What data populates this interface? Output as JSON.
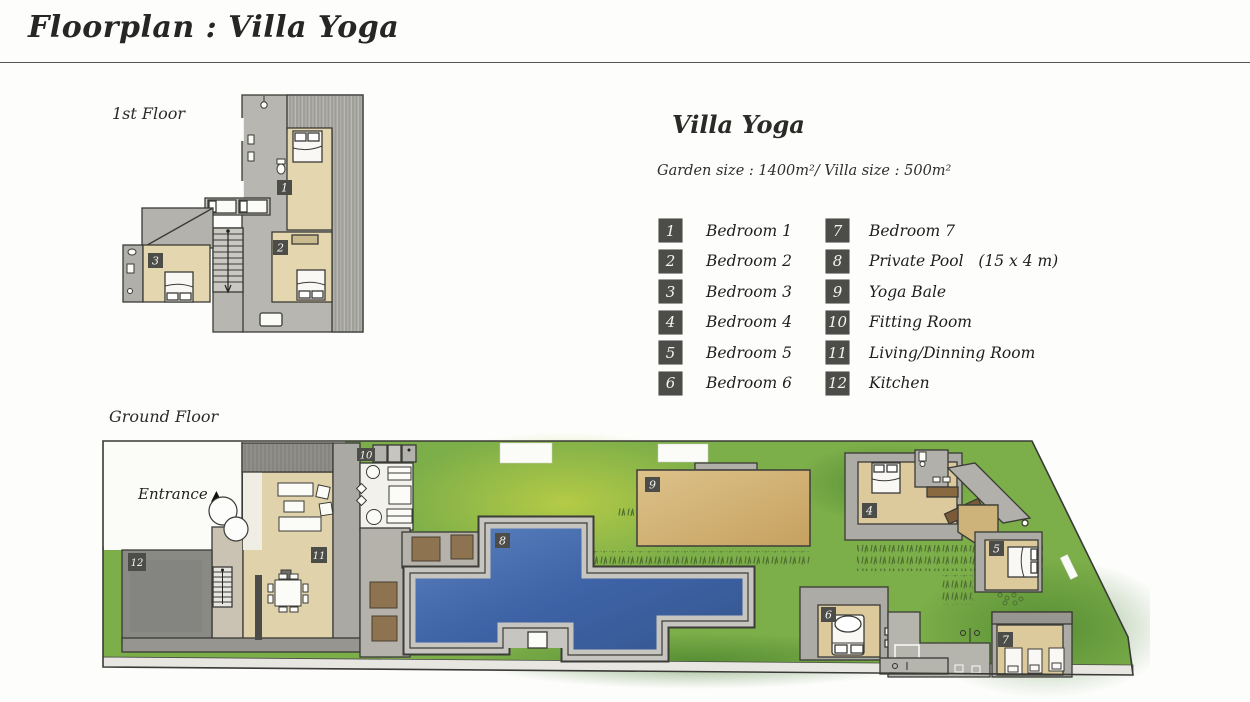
{
  "title": "Floorplan : Villa Yoga",
  "first_floor": {
    "label": "1st Floor"
  },
  "ground_floor": {
    "label": "Ground Floor",
    "entrance_label": "Entrance",
    "entrance_arrow": "▲"
  },
  "villa": {
    "name": "Villa Yoga",
    "size_line": "Garden size : 1400m²/ Villa size : 500m²"
  },
  "legend": {
    "items": [
      {
        "num": "1",
        "label": "Bedroom 1"
      },
      {
        "num": "2",
        "label": "Bedroom 2"
      },
      {
        "num": "3",
        "label": "Bedroom 3"
      },
      {
        "num": "4",
        "label": "Bedroom 4"
      },
      {
        "num": "5",
        "label": "Bedroom 5"
      },
      {
        "num": "6",
        "label": "Bedroom 6"
      },
      {
        "num": "7",
        "label": "Bedroom 7"
      },
      {
        "num": "8",
        "label": "Private Pool   (15 x 4 m)"
      },
      {
        "num": "9",
        "label": "Yoga Bale"
      },
      {
        "num": "10",
        "label": "Fitting Room"
      },
      {
        "num": "11",
        "label": "Living/Dinning Room"
      },
      {
        "num": "12",
        "label": "Kitchen"
      }
    ]
  },
  "badges": {
    "b1": "1",
    "b2": "2",
    "b3": "3",
    "b4": "4",
    "b5": "5",
    "b6": "6",
    "b7": "7",
    "b8": "8",
    "b9": "9",
    "b10": "10",
    "b11": "11",
    "b12": "12"
  },
  "colors": {
    "badge": "#4c4c49",
    "pool_blue": "#3c63a8",
    "grass_green": "#7cae49",
    "lawn_yellow_green": "#b5cc4d",
    "room_beige": "#e4d7af",
    "yoga_tan": "#d2b075",
    "wall_gray": "#acaba5",
    "kitchen_gray": "#8a8a85"
  }
}
